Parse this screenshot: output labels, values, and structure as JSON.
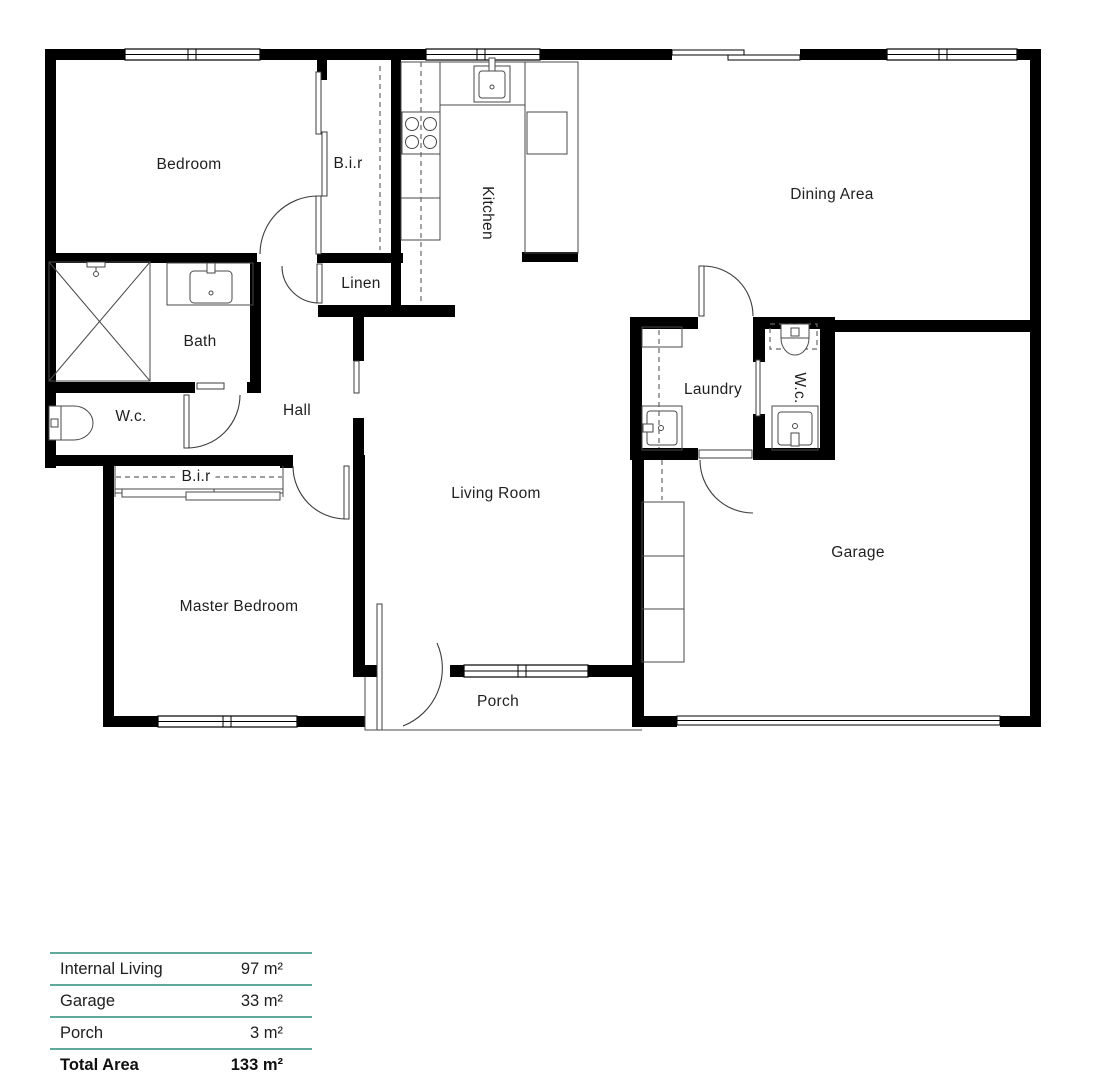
{
  "plan": {
    "rooms": [
      {
        "id": "bedroom",
        "label": "Bedroom"
      },
      {
        "id": "bir-top",
        "label": "B.i.r"
      },
      {
        "id": "kitchen",
        "label": "Kitchen"
      },
      {
        "id": "dining-area",
        "label": "Dining Area"
      },
      {
        "id": "linen",
        "label": "Linen"
      },
      {
        "id": "bath",
        "label": "Bath"
      },
      {
        "id": "wc-1",
        "label": "W.c."
      },
      {
        "id": "hall",
        "label": "Hall"
      },
      {
        "id": "laundry",
        "label": "Laundry"
      },
      {
        "id": "wc-2",
        "label": "W.c."
      },
      {
        "id": "living-room",
        "label": "Living Room"
      },
      {
        "id": "bir-bottom",
        "label": "B.i.r"
      },
      {
        "id": "master-bedroom",
        "label": "Master Bedroom"
      },
      {
        "id": "garage",
        "label": "Garage"
      },
      {
        "id": "porch",
        "label": "Porch"
      }
    ]
  },
  "area_table": {
    "rows": [
      {
        "label": "Internal Living",
        "value": "97 m²"
      },
      {
        "label": "Garage",
        "value": "33 m²"
      },
      {
        "label": "Porch",
        "value": "3 m²"
      },
      {
        "label": "Total Area",
        "value": "133 m²"
      }
    ]
  },
  "colors": {
    "wall": "#000000",
    "fixture": "#4a4a4a",
    "accent": "#5fa99a",
    "text": "#1f1f1f"
  }
}
